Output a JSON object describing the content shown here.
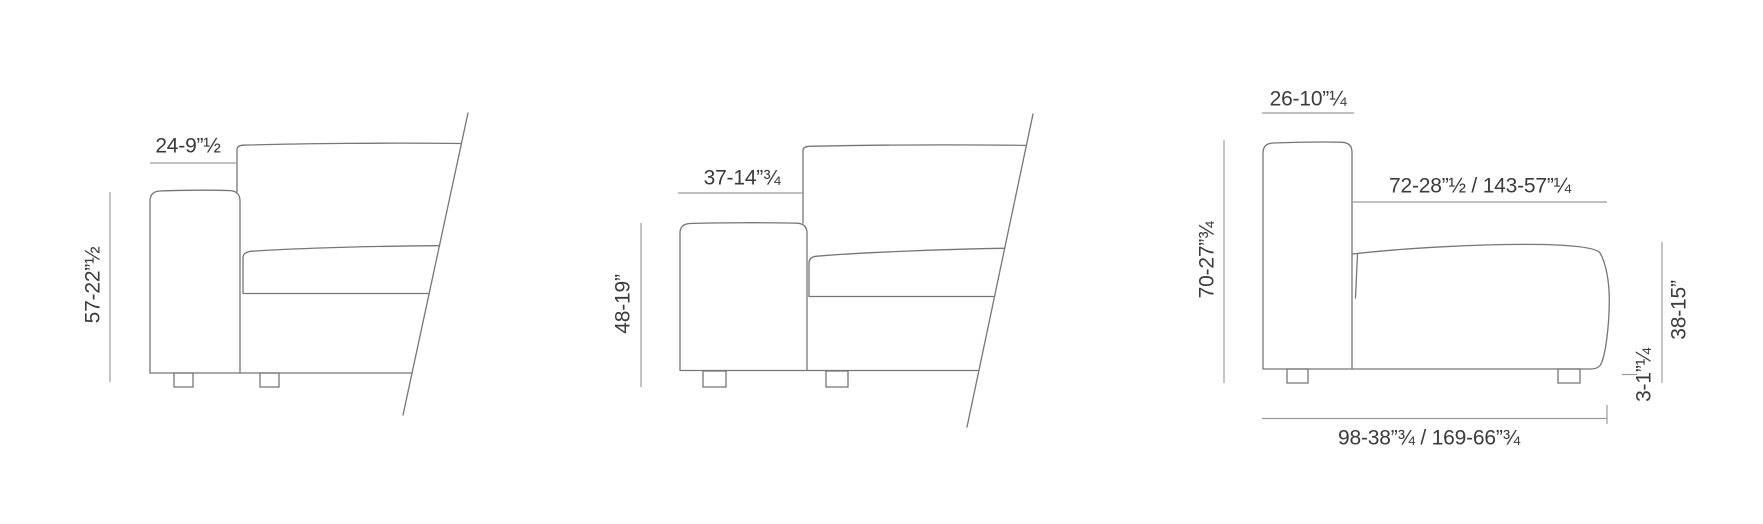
{
  "colors": {
    "text": "#3b3b3b",
    "furniture_line": "#767676",
    "dimension_line": "#9c9c9c"
  },
  "diagrams": [
    {
      "name": "high-arm-module-side-view",
      "dimensions": {
        "arm_width": "24-9”½",
        "arm_height": "57-22”½"
      }
    },
    {
      "name": "low-arm-module-side-view",
      "dimensions": {
        "arm_width": "37-14”¾",
        "arm_height": "48-19”"
      }
    },
    {
      "name": "armless-module-side-view",
      "dimensions": {
        "back_width": "26-10”¼",
        "total_height": "70-27”¾",
        "seat_length": "72-28”½ / 143-57”¼",
        "seat_height": "38-15”",
        "foot_height": "3-1”¼",
        "total_length": "98-38”¾ / 169-66”¾"
      }
    }
  ]
}
